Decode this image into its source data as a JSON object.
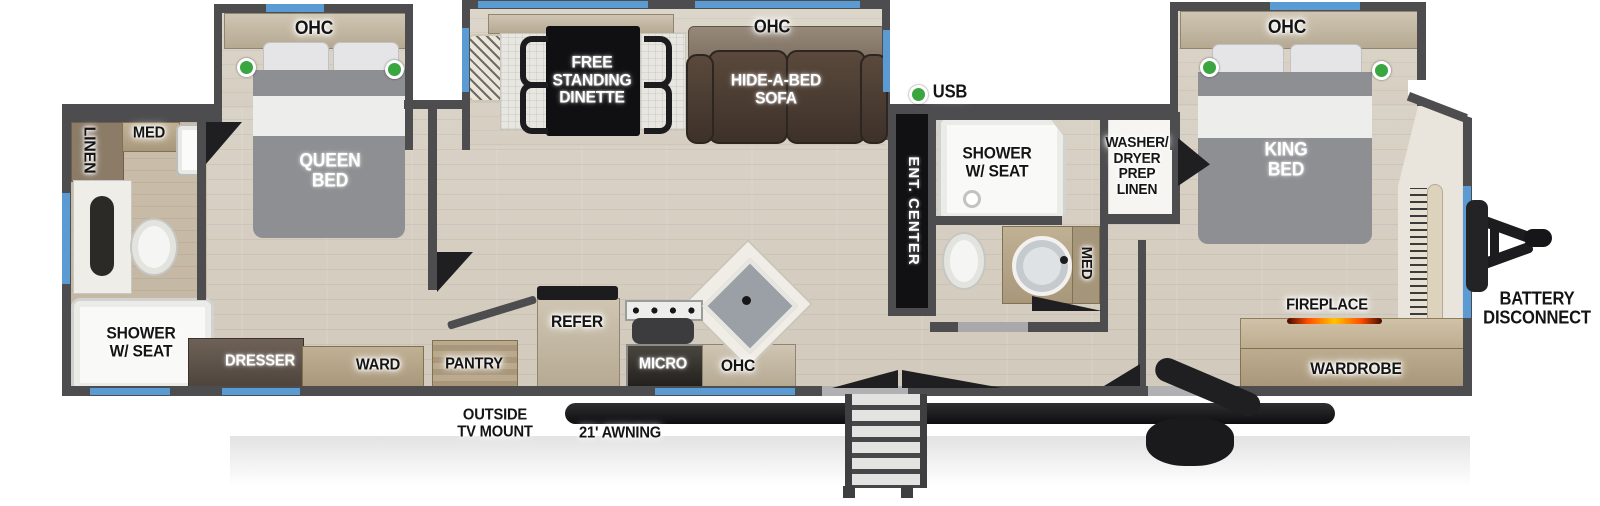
{
  "title": "Travel trailer floor plan",
  "colors": {
    "wall": "#4d4d4f",
    "window_blue": "#5a9bd4",
    "indicator_green": "#3aa63f",
    "fireplace_glow": "#ff5a00",
    "label_dark": "#141414",
    "label_light": "#ffffff",
    "cabinet_tan": "#b5a992",
    "sofa_brown": "#4a3a2f"
  },
  "labels": {
    "ohc_queen": "OHC",
    "linen_rear": "LINEN",
    "med_rear": "MED",
    "queen_bed": "QUEEN\nBED",
    "shower_rear": "SHOWER\nW/ SEAT",
    "dresser": "DRESSER",
    "ward": "WARD",
    "pantry": "PANTRY",
    "refer": "REFER",
    "micro": "MICRO",
    "ohc_kitchen": "OHC",
    "outside_tv_mount": "OUTSIDE\nTV MOUNT",
    "awning": "21' AWNING",
    "free_standing_dinette": "FREE\nSTANDING\nDINETTE",
    "ohc_living": "OHC",
    "hide_a_bed_sofa": "HIDE-A-BED\nSOFA",
    "usb": "USB",
    "ent_center": "ENT. CENTER",
    "shower_mid": "SHOWER\nW/ SEAT",
    "med_mid": "MED",
    "washer_dryer": "WASHER/\nDRYER\nPREP\nLINEN",
    "ohc_king": "OHC",
    "king_bed": "KING\nBED",
    "fireplace": "FIREPLACE",
    "wardrobe": "WARDROBE",
    "battery_disconnect": "BATTERY\nDISCONNECT"
  }
}
